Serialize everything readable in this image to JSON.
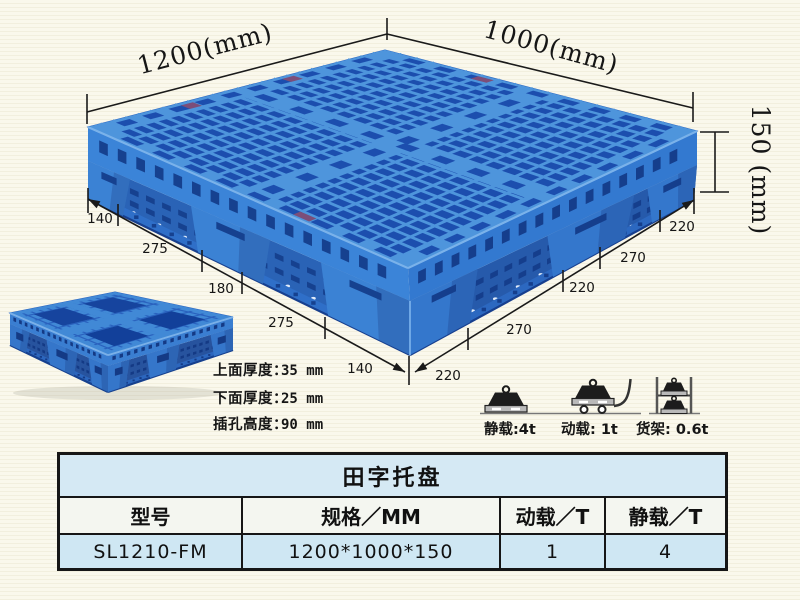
{
  "scene": {
    "colors": {
      "pallet_blue": "#4e95dc",
      "pallet_dark_blue": "#1c4eae",
      "pallet_side_blue": "#3b84d8",
      "table_title_bg": "#d5e9f4",
      "table_row_bg": "#cfe7f3",
      "line_color": "#161616",
      "background": "#faf8ec"
    }
  },
  "dimensions": {
    "length": "1200(mm)",
    "width": "1000(mm)",
    "height": "150 (mm)",
    "left_segments": [
      "140",
      "275",
      "180",
      "275",
      "140"
    ],
    "right_segments": [
      "220",
      "270",
      "220",
      "270",
      "220"
    ]
  },
  "notes": [
    {
      "label": "上面厚度：",
      "value": "35 mm"
    },
    {
      "label": "下面厚度：",
      "value": "25 mm"
    },
    {
      "label": "插孔高度：",
      "value": "90 mm"
    }
  ],
  "capacity": {
    "static": {
      "caption": "静载:4t"
    },
    "dynamic": {
      "caption": "动载: 1t"
    },
    "rack": {
      "caption": "货架: 0.6t"
    }
  },
  "table": {
    "title": "田字托盘",
    "headers": [
      "型号",
      "规格／MM",
      "动载／T",
      "静载／T"
    ],
    "row": [
      "SL1210-FM",
      "1200*1000*150",
      "1",
      "4"
    ]
  }
}
